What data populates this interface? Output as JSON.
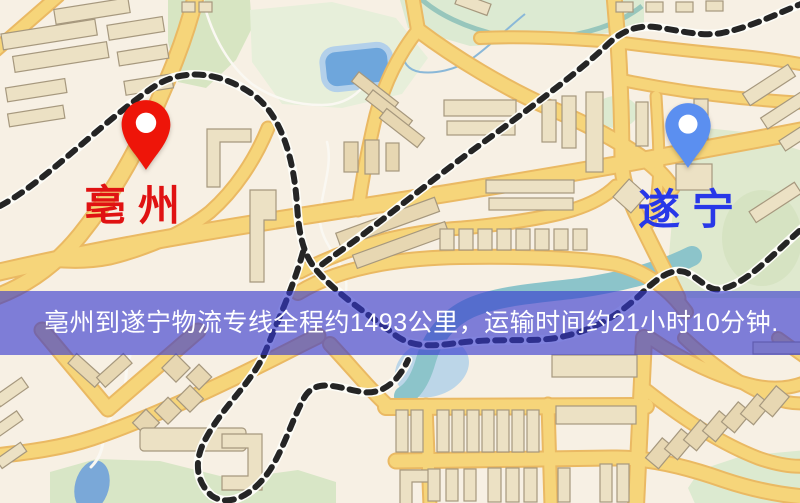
{
  "map": {
    "origin": {
      "name": "亳州"
    },
    "destination": {
      "name": "遂宁"
    },
    "banner": {
      "text": "亳州到遂宁物流专线全程约1493公里，运输时间约21小时10分钟.",
      "distance_km": "1493",
      "duration": "21小时10分钟"
    },
    "colors": {
      "origin_pin": "#ee1509",
      "origin_label": "#e01212",
      "destination_pin": "#5b8ff0",
      "destination_label": "#2838e8",
      "banner_background": "rgba(51,55,207,0.62)",
      "banner_text": "#ffffff",
      "road_fill": "#f6d57a",
      "road_casing": "#eab963",
      "railway": "#252525",
      "pond_water": "#6ea6dc",
      "river_water": "#8cc4ca",
      "park_green": "#d9e6c4",
      "building": "#ece1c4",
      "background": "#f7f0e4"
    }
  }
}
